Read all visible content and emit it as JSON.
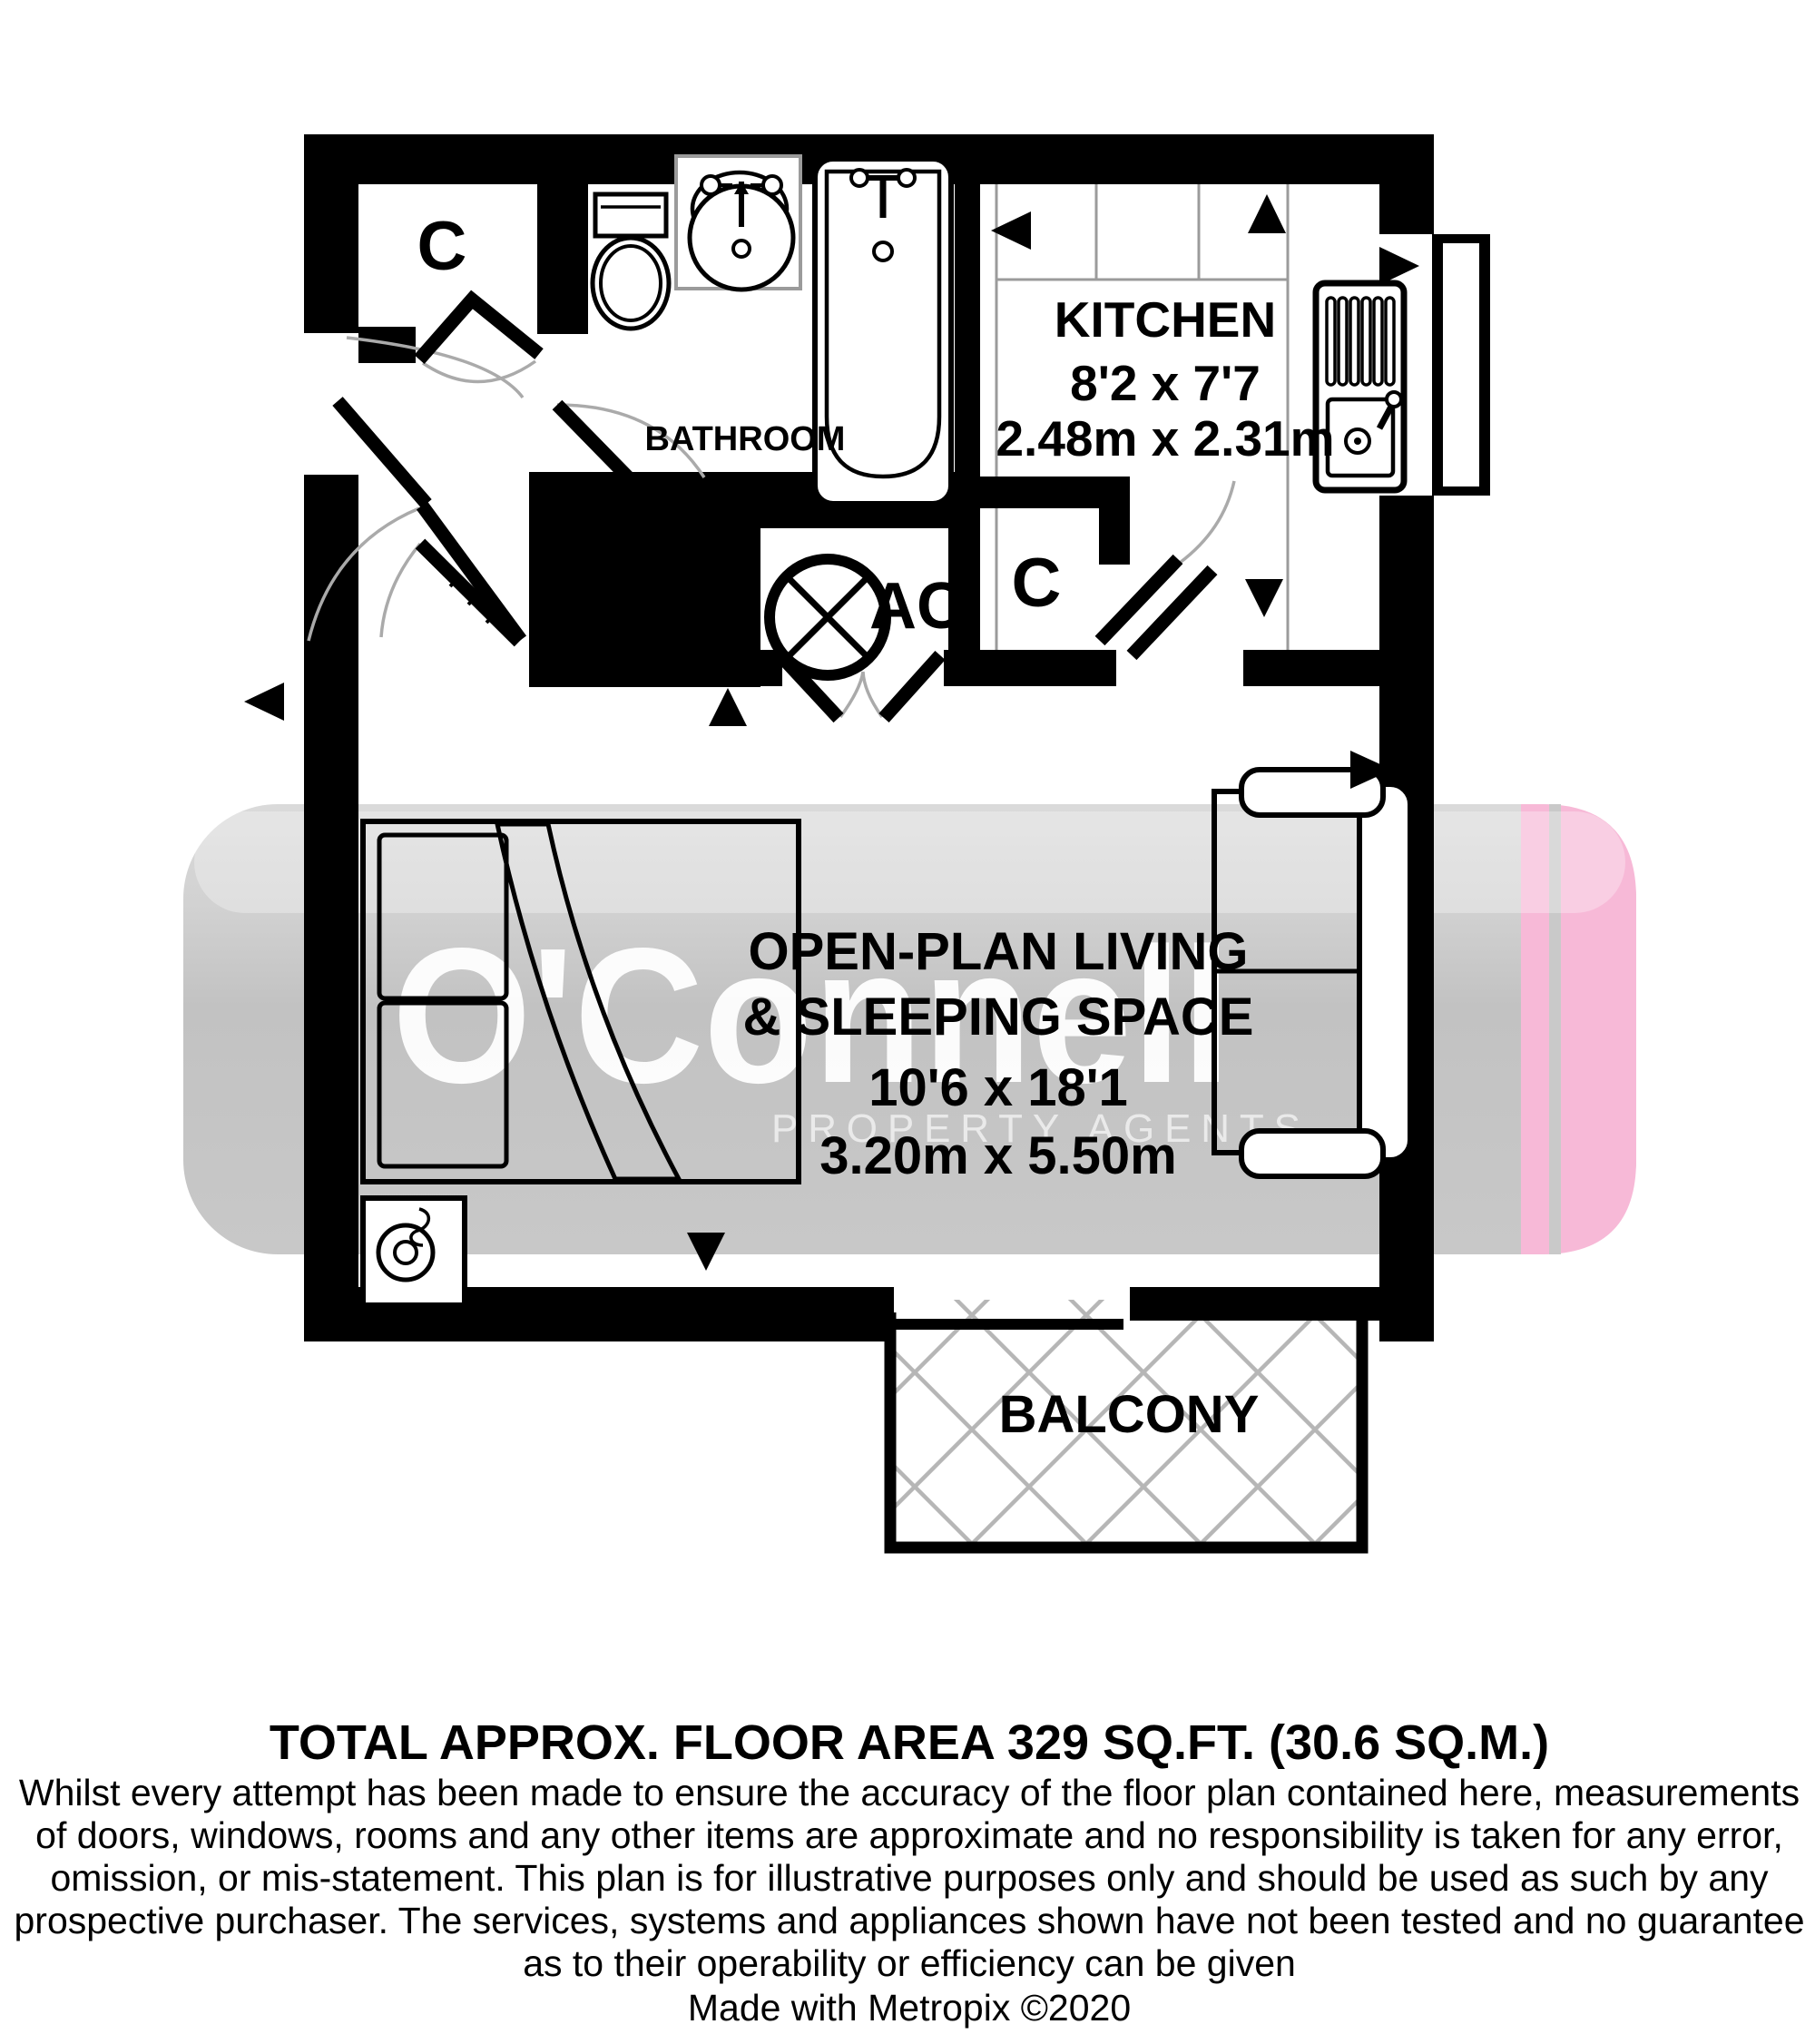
{
  "watermark": {
    "brand": "O'Connell",
    "tagline": "PROPERTY AGENTS",
    "band_color": "#c6c6c6",
    "pink_color": "#f7b9d7"
  },
  "rooms": {
    "kitchen": {
      "name": "KITCHEN",
      "imperial": "8'2 x 7'7",
      "metric": "2.48m x 2.31m"
    },
    "bathroom": {
      "name": "BATHROOM"
    },
    "living": {
      "name_line1": "OPEN-PLAN LIVING",
      "name_line2": "& SLEEPING SPACE",
      "imperial": "10'6 x 18'1",
      "metric": "3.20m x 5.50m"
    },
    "balcony": {
      "name": "BALCONY"
    },
    "closet_hall": {
      "label": "C"
    },
    "closet_kitchen": {
      "label": "C"
    },
    "ac_unit": {
      "label": "AC"
    }
  },
  "footer": {
    "area_summary": "TOTAL APPROX. FLOOR AREA 329 SQ.FT. (30.6 SQ.M.)",
    "disclaimer": [
      "Whilst every attempt has been made to ensure the accuracy of the floor plan contained here, measurements",
      "of doors, windows, rooms and any other items are approximate and no responsibility is taken for any error,",
      "omission, or mis-statement. This plan is for illustrative purposes only and should be used as such by any",
      "prospective purchaser. The services, systems and appliances shown have not been tested and no guarantee",
      "as to their operability or efficiency can be given"
    ],
    "credit": "Made with Metropix ©2020"
  }
}
